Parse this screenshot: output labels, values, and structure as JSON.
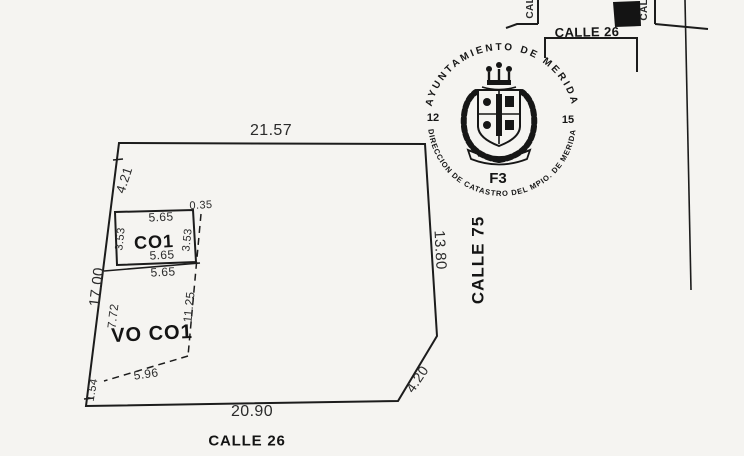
{
  "seal": {
    "top_arc": "AYUNTAMIENTO DE MERIDA",
    "bottom_arc": "DIRECCION DE CATASTRO DEL MPIO. DE MERIDA",
    "left_number": "12",
    "right_number": "15",
    "zone_code": "F3"
  },
  "minimap": {
    "horizontal_street": "CALLE 26",
    "left_street": "CALLE",
    "right_street": "CALLE"
  },
  "plot": {
    "bottom_street": "CALLE 26",
    "right_street": "CALLE 75",
    "construction_label": "CO1",
    "open_label": "VO CO1",
    "dim_top": "21.57",
    "dim_left_total": "17.00",
    "dim_left_seg_top": "4.21",
    "dim_left_seg_co1": "3.53",
    "dim_left_seg_vo": "7.72",
    "dim_left_seg_bottom": "1.54",
    "dim_right": "13.80",
    "dim_bottom": "20.90",
    "dim_chamfer": "4.20",
    "dim_co1_top": "5.65",
    "dim_co1_right": "3.53",
    "dim_co1_bottom": "5.65",
    "dim_co1_below": "5.65",
    "dim_co1_gap": "0.35",
    "dim_vo_right": "11.25",
    "dim_vo_bottom": "5.96"
  },
  "colors": {
    "ink": "#1c1c1c",
    "paper": "#f5f4f1"
  }
}
